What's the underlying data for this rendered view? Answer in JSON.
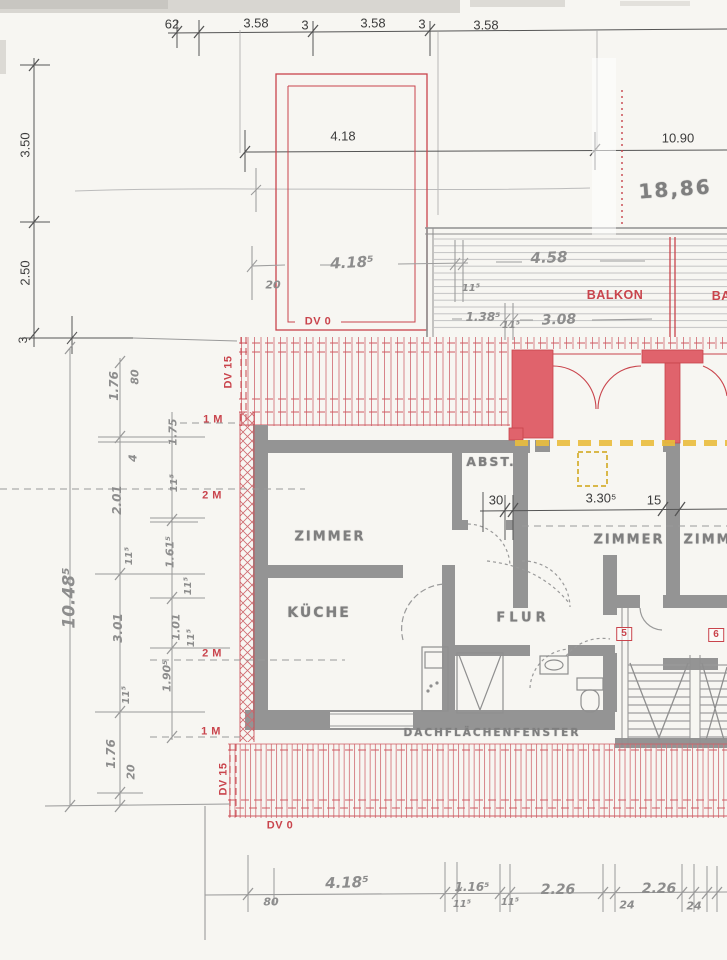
{
  "colors": {
    "paper": "#f7f6f2",
    "accent_red": "#c9444c",
    "wall_red_fill": "#e0636c",
    "roof_hatch_red": "#d4787e",
    "wall_gray": "#949494",
    "printed_ink": "#3c3c3c",
    "pencil_gray": "#9a9a9a",
    "height_line_yellow": "#e9bc3c"
  },
  "annotations": {
    "top_dim_chain": [
      {
        "name": "dim-top-62",
        "text": "62",
        "x": 172,
        "y": 24,
        "cls": "ink",
        "size": 13
      },
      {
        "name": "dim-top-358a",
        "text": "3.58",
        "x": 256,
        "y": 23,
        "cls": "ink",
        "size": 13
      },
      {
        "name": "dim-top-3a",
        "text": "3",
        "x": 305,
        "y": 25,
        "cls": "ink",
        "size": 13
      },
      {
        "name": "dim-top-358b",
        "text": "3.58",
        "x": 373,
        "y": 23,
        "cls": "ink",
        "size": 13
      },
      {
        "name": "dim-top-3b",
        "text": "3",
        "x": 422,
        "y": 24,
        "cls": "ink",
        "size": 13
      },
      {
        "name": "dim-top-358c",
        "text": "3.58",
        "x": 486,
        "y": 25,
        "cls": "ink",
        "size": 13
      }
    ],
    "left_dim_chain": [
      {
        "name": "dim-left-350",
        "text": "3.50",
        "x": 25,
        "y": 145,
        "rot": -90,
        "cls": "ink",
        "size": 13
      },
      {
        "name": "dim-left-250",
        "text": "2.50",
        "x": 25,
        "y": 273,
        "rot": -90,
        "cls": "ink",
        "size": 13
      },
      {
        "name": "dim-left-3",
        "text": "3",
        "x": 23,
        "y": 340,
        "rot": -90,
        "cls": "ink",
        "size": 12
      }
    ],
    "mid_dims": [
      {
        "name": "dim-418",
        "text": "4.18",
        "x": 343,
        "y": 136,
        "cls": "ink",
        "size": 13
      },
      {
        "name": "dim-1090",
        "text": "10.90",
        "x": 678,
        "y": 138,
        "cls": "ink",
        "size": 13
      },
      {
        "name": "stamp-1886",
        "text": "18,86",
        "x": 675,
        "y": 189,
        "rot": -4,
        "cls": "stamp",
        "size": 20
      }
    ],
    "interior_dims": [
      {
        "name": "dim-30",
        "text": "30",
        "x": 496,
        "y": 500,
        "cls": "ink",
        "size": 13
      },
      {
        "name": "dim-3305",
        "text": "3.30⁵",
        "x": 601,
        "y": 498,
        "cls": "ink",
        "size": 13
      },
      {
        "name": "dim-15",
        "text": "15",
        "x": 654,
        "y": 500,
        "cls": "ink",
        "size": 13
      }
    ],
    "terrace_balcony": [
      {
        "name": "hw-dim-418-top",
        "text": "4.18⁵",
        "x": 352,
        "y": 263,
        "rot": -3,
        "cls": "hw",
        "size": 15
      },
      {
        "name": "hw-dim-20-top",
        "text": "20",
        "x": 273,
        "y": 285,
        "cls": "hw",
        "size": 11
      },
      {
        "name": "hw-dim-115-a",
        "text": "11⁵",
        "x": 471,
        "y": 289,
        "cls": "hw",
        "size": 10
      },
      {
        "name": "hw-dim-458",
        "text": "4.58",
        "x": 549,
        "y": 258,
        "rot": -2,
        "cls": "hw",
        "size": 15
      },
      {
        "name": "hw-dim-1385",
        "text": "1.38⁵",
        "x": 483,
        "y": 317,
        "cls": "hw",
        "size": 12
      },
      {
        "name": "hw-dim-115-b",
        "text": "11⁵",
        "x": 511,
        "y": 326,
        "cls": "hw",
        "size": 10
      },
      {
        "name": "hw-dim-308",
        "text": "3.08",
        "x": 559,
        "y": 320,
        "rot": -2,
        "cls": "hw",
        "size": 14
      },
      {
        "name": "balkon-label-1",
        "text": "BALKON",
        "x": 615,
        "y": 295,
        "cls": "red",
        "size": 12.5
      },
      {
        "name": "balkon-label-2",
        "text": "BALKON",
        "x": 740,
        "y": 296,
        "cls": "red",
        "size": 12.5
      }
    ],
    "roof_labels": [
      {
        "name": "dv0-top-label",
        "text": "DV 0",
        "x": 318,
        "y": 322,
        "cls": "red",
        "size": 11
      },
      {
        "name": "dv15-top-label",
        "text": "DV 15",
        "x": 229,
        "y": 372,
        "rot": -90,
        "cls": "red",
        "size": 11
      },
      {
        "name": "height-1m-top",
        "text": "1 M",
        "x": 213,
        "y": 420,
        "cls": "red",
        "size": 11
      },
      {
        "name": "height-2m-top",
        "text": "2 M",
        "x": 212,
        "y": 496,
        "cls": "red",
        "size": 11
      },
      {
        "name": "height-2m-bottom",
        "text": "2 M",
        "x": 212,
        "y": 654,
        "cls": "red",
        "size": 11
      },
      {
        "name": "height-1m-bottom",
        "text": "1 M",
        "x": 211,
        "y": 732,
        "cls": "red",
        "size": 11
      },
      {
        "name": "dv15-bottom-label",
        "text": "DV 15",
        "x": 224,
        "y": 779,
        "rot": -90,
        "cls": "red",
        "size": 11
      },
      {
        "name": "dv0-bottom-label",
        "text": "DV 0",
        "x": 280,
        "y": 826,
        "cls": "red",
        "size": 11
      }
    ],
    "rooms": [
      {
        "name": "room-zimmer-left",
        "text": "ZIMMER",
        "x": 330,
        "y": 537,
        "cls": "stamp",
        "size": 13
      },
      {
        "name": "room-kueche",
        "text": "KÜCHE",
        "x": 319,
        "y": 613,
        "cls": "stamp",
        "size": 14
      },
      {
        "name": "room-abst",
        "text": "ABST.",
        "x": 491,
        "y": 462,
        "cls": "stamp",
        "size": 12.5
      },
      {
        "name": "room-flur",
        "text": "FLUR",
        "x": 523,
        "y": 618,
        "cls": "stamp wide",
        "size": 13
      },
      {
        "name": "room-zimmer-mid",
        "text": "ZIMMER",
        "x": 629,
        "y": 540,
        "cls": "stamp",
        "size": 13
      },
      {
        "name": "room-zimmer-right",
        "text": "ZIMMER",
        "x": 719,
        "y": 540,
        "cls": "stamp",
        "size": 13
      },
      {
        "name": "label-dachflaechenfenster",
        "text": "DACHFLÄCHENFENSTER",
        "x": 492,
        "y": 733,
        "cls": "stamp",
        "size": 10.5
      }
    ],
    "stair_numbers": [
      {
        "name": "stair-flat-5",
        "text": "5",
        "x": 624,
        "y": 634,
        "cls": "redbox",
        "size": 10
      },
      {
        "name": "stair-flat-6",
        "text": "6",
        "x": 716,
        "y": 635,
        "cls": "redbox",
        "size": 10
      }
    ],
    "left_hand_chain": [
      {
        "name": "hw-dim-1048",
        "text": "10.48⁵",
        "x": 70,
        "y": 598,
        "rot": -90,
        "cls": "hw",
        "size": 17
      },
      {
        "name": "hw-dim-176-a",
        "text": "1.76",
        "x": 114,
        "y": 386,
        "rot": -90,
        "cls": "hw",
        "size": 12
      },
      {
        "name": "hw-dim-80-a",
        "text": "80",
        "x": 135,
        "y": 377,
        "rot": -90,
        "cls": "hw",
        "size": 11
      },
      {
        "name": "hw-dim-4",
        "text": "4",
        "x": 133,
        "y": 458,
        "rot": -90,
        "cls": "hw",
        "size": 11
      },
      {
        "name": "hw-dim-201",
        "text": "2.01",
        "x": 117,
        "y": 500,
        "rot": -90,
        "cls": "hw",
        "size": 12
      },
      {
        "name": "hw-dim-115-c",
        "text": "11⁵",
        "x": 130,
        "y": 556,
        "rot": -90,
        "cls": "hw",
        "size": 10
      },
      {
        "name": "hw-dim-301",
        "text": "3.01",
        "x": 118,
        "y": 628,
        "rot": -90,
        "cls": "hw",
        "size": 12
      },
      {
        "name": "hw-dim-115-d",
        "text": "11⁵",
        "x": 127,
        "y": 695,
        "rot": -90,
        "cls": "hw",
        "size": 10
      },
      {
        "name": "hw-dim-176-b",
        "text": "1.76",
        "x": 111,
        "y": 754,
        "rot": -90,
        "cls": "hw",
        "size": 12
      },
      {
        "name": "hw-dim-20-b",
        "text": "20",
        "x": 131,
        "y": 772,
        "rot": -90,
        "cls": "hw",
        "size": 11
      },
      {
        "name": "hw-dim-175",
        "text": "1.75",
        "x": 173,
        "y": 432,
        "rot": -90,
        "cls": "hw",
        "size": 11
      },
      {
        "name": "hw-dim-115-e",
        "text": "11⁵",
        "x": 175,
        "y": 483,
        "rot": -90,
        "cls": "hw",
        "size": 10
      },
      {
        "name": "hw-dim-1615",
        "text": "1.61⁵",
        "x": 170,
        "y": 552,
        "rot": -90,
        "cls": "hw",
        "size": 11
      },
      {
        "name": "hw-dim-115-f",
        "text": "11⁵",
        "x": 189,
        "y": 586,
        "rot": -90,
        "cls": "hw",
        "size": 10
      },
      {
        "name": "hw-dim-101",
        "text": "1.01",
        "x": 176,
        "y": 627,
        "rot": -90,
        "cls": "hw",
        "size": 11
      },
      {
        "name": "hw-dim-115-g",
        "text": "11⁵",
        "x": 192,
        "y": 638,
        "rot": -90,
        "cls": "hw",
        "size": 10
      },
      {
        "name": "hw-dim-1905",
        "text": "1.90⁵",
        "x": 167,
        "y": 676,
        "rot": -90,
        "cls": "hw",
        "size": 11
      }
    ],
    "bottom_hand_chain": [
      {
        "name": "hw-dim-80-bot",
        "text": "80",
        "x": 271,
        "y": 902,
        "cls": "hw",
        "size": 11
      },
      {
        "name": "hw-dim-4185-bot",
        "text": "4.18⁵",
        "x": 347,
        "y": 883,
        "rot": -2,
        "cls": "hw",
        "size": 15
      },
      {
        "name": "hw-dim-1165",
        "text": "1.16⁵",
        "x": 472,
        "y": 887,
        "cls": "hw",
        "size": 12
      },
      {
        "name": "hw-dim-115-h",
        "text": "11⁵",
        "x": 462,
        "y": 905,
        "cls": "hw",
        "size": 10
      },
      {
        "name": "hw-dim-115-i",
        "text": "11⁵",
        "x": 510,
        "y": 903,
        "cls": "hw",
        "size": 10
      },
      {
        "name": "hw-dim-226-a",
        "text": "2.26",
        "x": 558,
        "y": 890,
        "cls": "hw",
        "size": 14
      },
      {
        "name": "hw-dim-24-a",
        "text": "24",
        "x": 627,
        "y": 905,
        "cls": "hw",
        "size": 11
      },
      {
        "name": "hw-dim-226-b",
        "text": "2.26",
        "x": 659,
        "y": 889,
        "cls": "hw",
        "size": 14
      },
      {
        "name": "hw-dim-24-b",
        "text": "24",
        "x": 694,
        "y": 906,
        "cls": "hw",
        "size": 11
      }
    ]
  }
}
